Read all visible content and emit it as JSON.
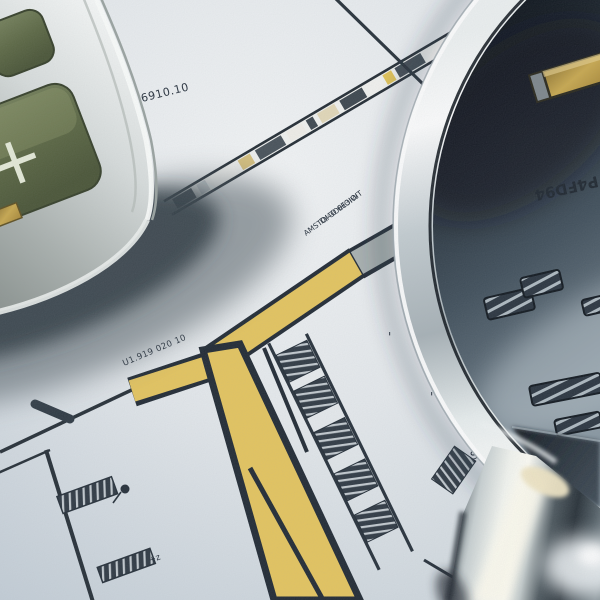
{
  "scene": {
    "objects": [
      "calculator",
      "magnifying-glass",
      "blueprint-drawing"
    ]
  },
  "texts": {
    "paper_number": "6910.10",
    "note_line_1": "AMSTOI 3OIHOIW",
    "note_line_2": "D/4O 6E3IOIT",
    "part_label": "U1.919 020 10",
    "lens_code": "P4FD94",
    "plus_key": "+",
    "z_mark": "+z",
    "s_mark": "S",
    "tick_1": "'",
    "tick_2": "'"
  },
  "colors": {
    "paper": "#e8ebee",
    "highlight_yellow": "#e6c55c",
    "key_olive": "#5f6b45",
    "lens_dark": "#101820",
    "chrome": "#e8ecec",
    "line_ink": "#1e2630",
    "gold": "#c9a84c"
  }
}
